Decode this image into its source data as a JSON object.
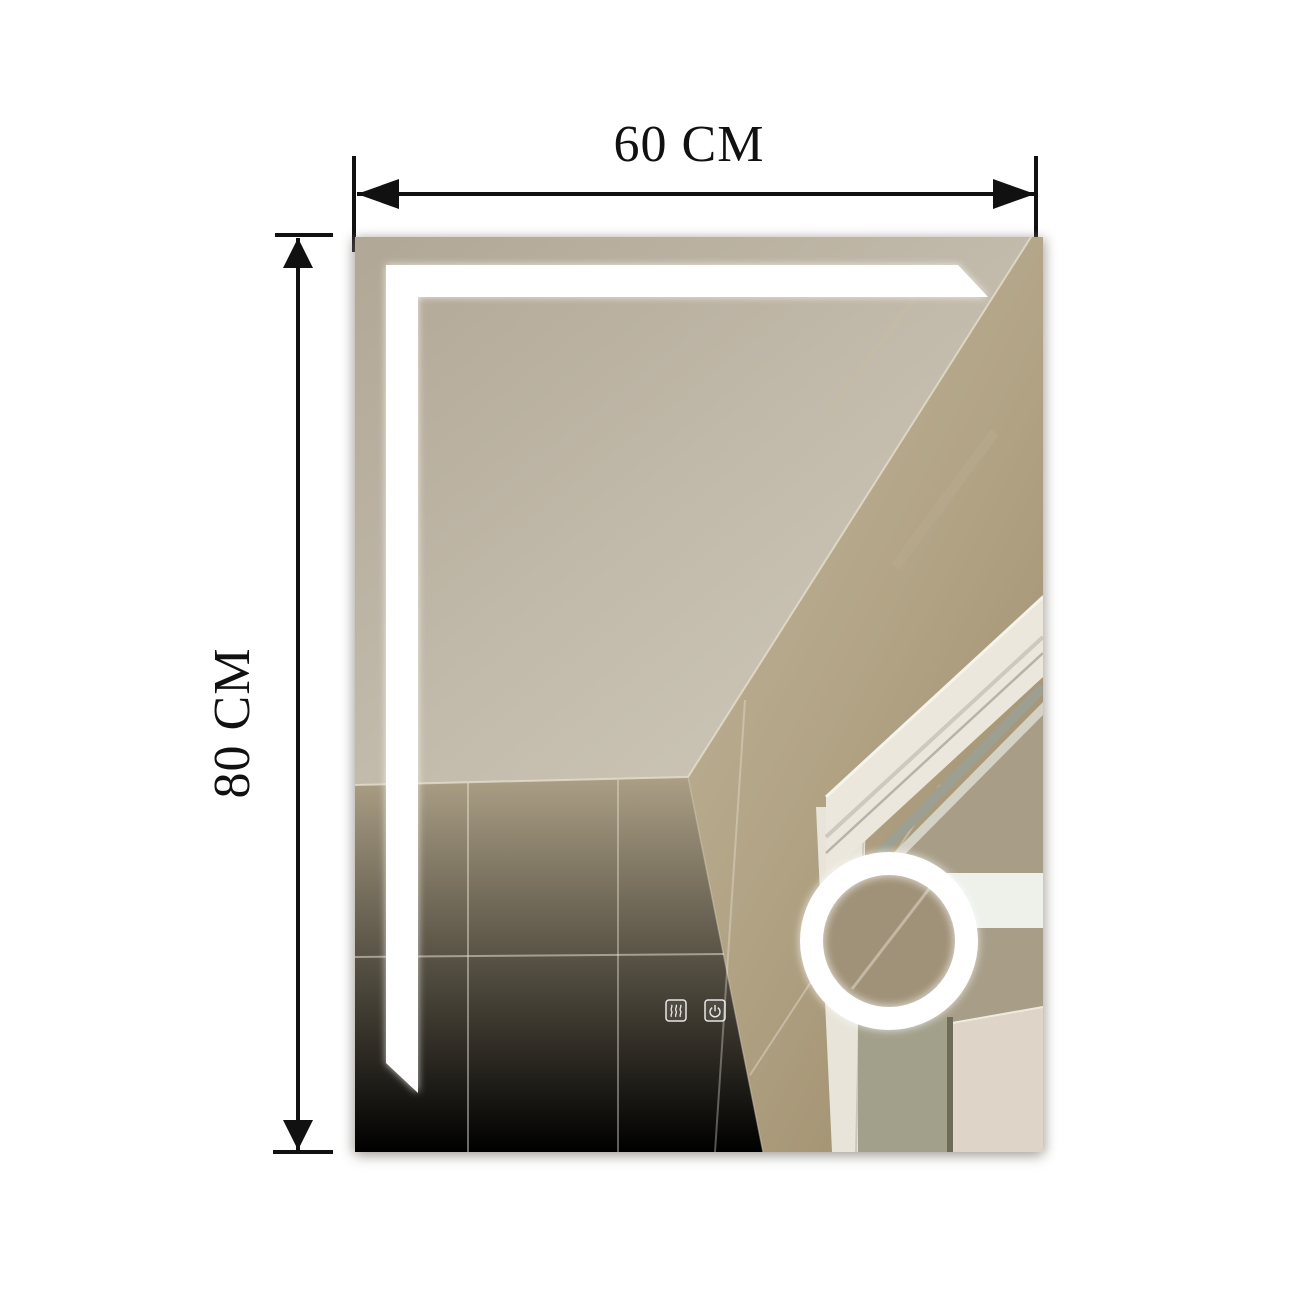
{
  "scene": {
    "description": "LED bathroom mirror product dimension image showing reflected bathroom ceiling, tiled walls and door frame"
  },
  "dimensions": {
    "width_label": "60 CM",
    "height_label": "80 CM"
  },
  "mirror": {
    "features": [
      "l-shaped-led-strip",
      "round-magnifier-ring",
      "touch-controls"
    ],
    "touch_controls": [
      {
        "name": "defogger",
        "icon": "steam-waves-icon"
      },
      {
        "name": "power",
        "icon": "power-icon"
      }
    ]
  },
  "colors": {
    "background": "#ffffff",
    "dimension_lines": "#111111",
    "ceiling": "#c4bcac",
    "wall_left": "#998c70",
    "wall_right": "#b2a488",
    "led_strip": "#ffffff",
    "magnifier_ring": "#ffffff",
    "door_frame": "#ebe7dc",
    "door_panel": "#ded4c7",
    "glass_band": "#9da090",
    "light_band": "#edf1ea"
  }
}
